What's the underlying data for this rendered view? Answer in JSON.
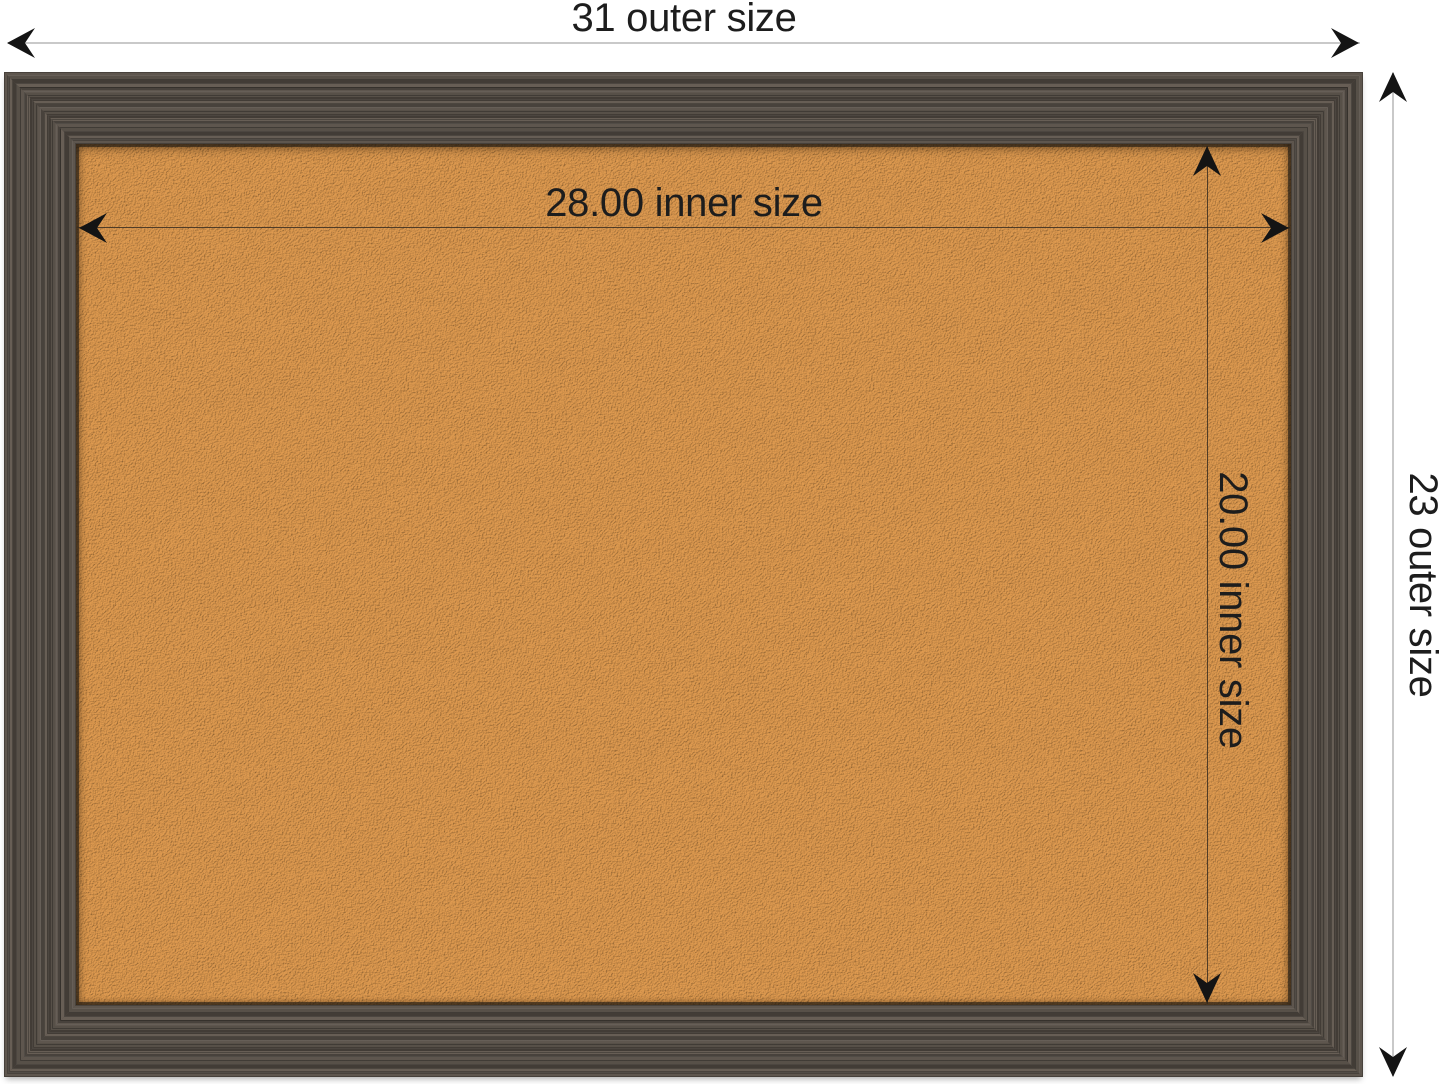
{
  "diagram": {
    "labels": {
      "outer_width": "31 outer size",
      "outer_height": "23 outer size",
      "inner_width": "28.00 inner size",
      "inner_height": "20.00 inner size"
    },
    "icons": {
      "arrow_left": "dimension-arrowhead-left",
      "arrow_right": "dimension-arrowhead-right",
      "arrow_up": "dimension-arrowhead-up",
      "arrow_down": "dimension-arrowhead-down"
    },
    "colors": {
      "background": "#ffffff",
      "outer_dimension_line": "#c9c9c9",
      "inner_dimension_line": "#34291f",
      "arrowhead": "#141414",
      "label_text": "#1d1d1d",
      "frame_base": "#544d46",
      "frame_dark": "#423c36",
      "frame_light": "#675e55",
      "cork_base": "#d89e5c",
      "cork_light": "#ecca94",
      "cork_dark": "#b5813f"
    }
  }
}
